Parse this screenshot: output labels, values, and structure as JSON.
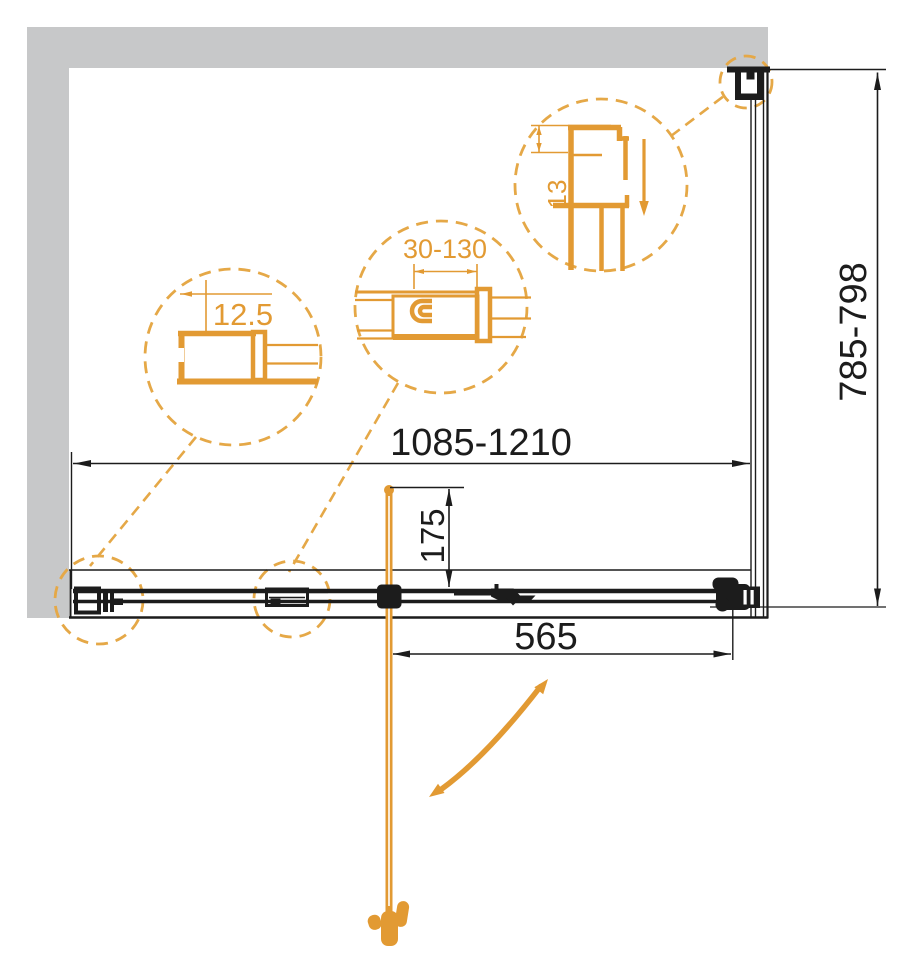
{
  "drawing": {
    "type": "shower-enclosure-top-view-technical-drawing",
    "dimensions": {
      "width_range": "1085-1210",
      "depth_range": "785-798",
      "door_width": "565",
      "handle_offset": "175",
      "adjustment_range": "30-130",
      "wall_profile_width": "12.5",
      "corner_profile_depth": "13"
    },
    "colors": {
      "accent_orange": "#E29A33",
      "accent_orange_dashed": "#E5A847",
      "line_black": "#1C1C1C",
      "wall_gray": "#C7C8C9",
      "background": "#FFFFFF"
    }
  }
}
